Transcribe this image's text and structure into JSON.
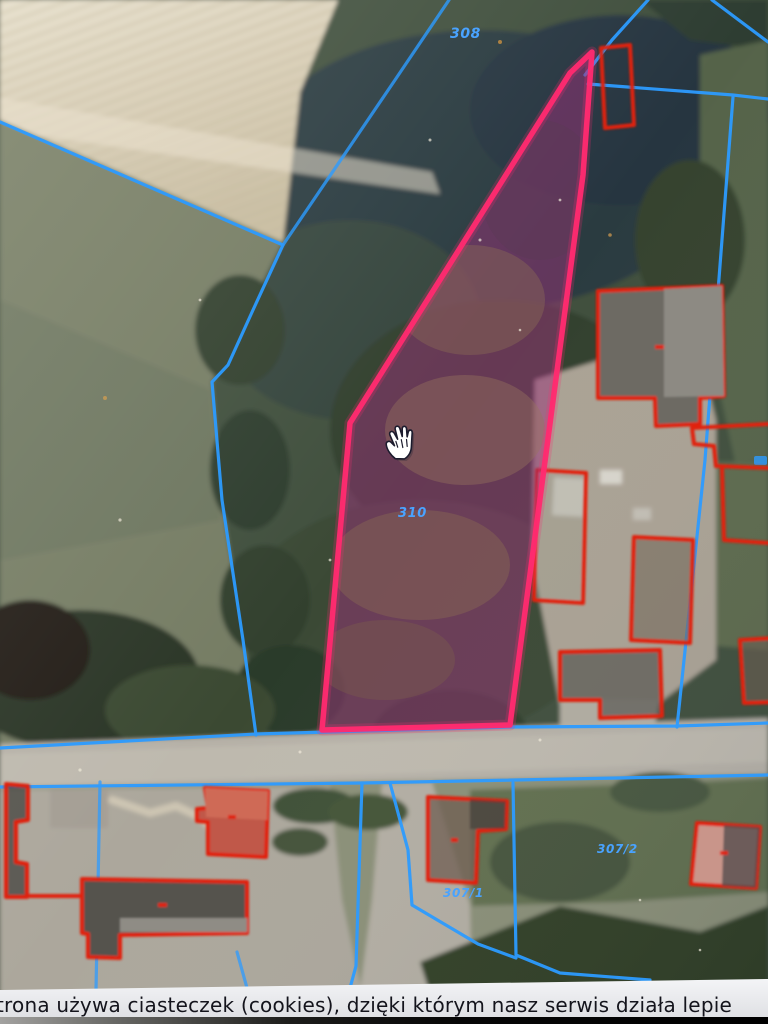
{
  "map": {
    "parcel_labels": {
      "north": "308",
      "selected": "310",
      "southeast": "307/2",
      "south": "307/1"
    },
    "colors": {
      "cadastral_line": "#2d9bff",
      "building_outline": "#e0220f",
      "selected_outline": "#ff2a70",
      "selected_fill": "rgba(150,52,118,0.52)",
      "label_blue": "#4aa3ff"
    },
    "cursor": "open-hand-cursor"
  },
  "cookie_banner": {
    "text": "trona używa ciasteczek (cookies), dzięki którym nasz serwis działa lepie",
    "background": "#e9eaed",
    "text_color": "#14141c"
  }
}
